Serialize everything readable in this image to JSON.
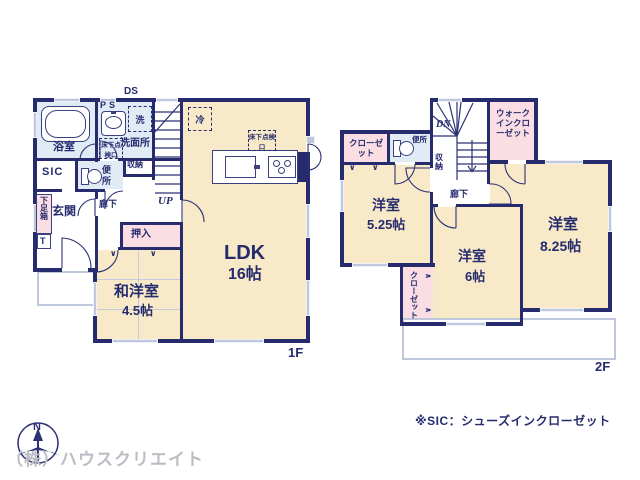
{
  "floor1": {
    "floor_label": "1F",
    "duct": "DS",
    "up": "UP",
    "bathroom": "浴室",
    "pipe_space": "PS",
    "washer": "洗",
    "washroom": "洗面所",
    "underfloor_hatch": "床下点検口",
    "closet_small": "収納",
    "sic": "SIC",
    "toilet": "便所",
    "entrance": "玄関",
    "shoe_box": "下足箱",
    "shoe_box_t": "T",
    "hallway": "廊下",
    "oshiire": "押入",
    "tatami_room": "和洋室",
    "tatami_room_size": "4.5帖",
    "ldk": "LDK",
    "ldk_size": "16帖",
    "fridge": "冷",
    "ldk_underfloor_hatch": "床下点検口"
  },
  "floor2": {
    "floor_label": "2F",
    "down": "DN",
    "walk_in_closet": "ウォークインクローゼット",
    "closet_top": "クローゼット",
    "toilet": "便所",
    "closet_small": "収納",
    "hallway": "廊下",
    "bedroom_a": "洋室",
    "bedroom_a_size": "5.25帖",
    "bedroom_b": "洋室",
    "bedroom_b_size": "6帖",
    "bedroom_c": "洋室",
    "bedroom_c_size": "8.25帖",
    "closet_side": "クローゼット"
  },
  "footer": {
    "note": "※SIC：シューズインクローゼット",
    "watermark": "（株）ハウスクリエイト",
    "compass_north": "N"
  },
  "colors": {
    "wall": "#262b6e",
    "room_beige": "#f8eac8",
    "room_blue": "#e1ebf5",
    "room_pink": "#fbdee4",
    "window_gray": "#bfc7dc",
    "text": "#262b6e",
    "watermark": "#bcbcc4"
  }
}
